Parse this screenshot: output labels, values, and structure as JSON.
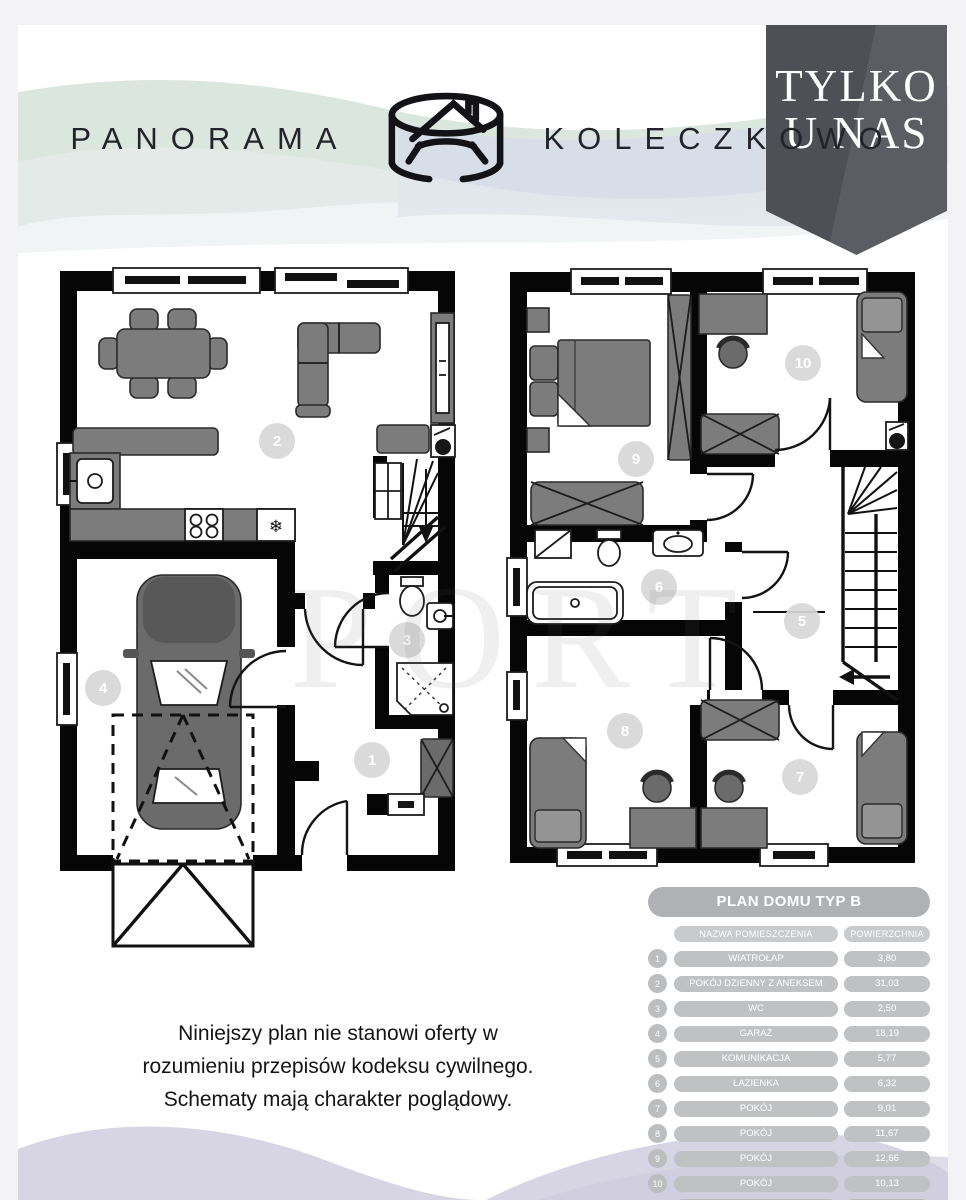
{
  "header": {
    "brand_left": "PANORAMA",
    "brand_right": "KOLECZKOWO"
  },
  "ribbon": {
    "line1": "TYLKO",
    "line2": "U NAS"
  },
  "watermark": {
    "text": "PORT"
  },
  "plan_labels": {
    "n1": "1",
    "n2": "2",
    "n3": "3",
    "n4": "4",
    "n5": "5",
    "n6": "6",
    "n7": "7",
    "n8": "8",
    "n9": "9",
    "n10": "10"
  },
  "icons": {
    "fridge": "❄",
    "house_logo": "circular-house-logo"
  },
  "disclaimer": {
    "line1": "Niniejszy plan nie stanowi oferty w",
    "line2": "rozumieniu przepisów kodeksu cywilnego.",
    "line3": "Schematy mają charakter poglądowy."
  },
  "table": {
    "title": "PLAN DOMU TYP B",
    "col_name": "NAZWA POMIESZCZENIA",
    "col_area": "POWIERZCHNIA",
    "rows": [
      {
        "no": "1",
        "name": "WIATROŁAP",
        "area": "3,80"
      },
      {
        "no": "2",
        "name": "POKÓJ DZIENNY Z ANEKSEM",
        "area": "31,03"
      },
      {
        "no": "3",
        "name": "WC",
        "area": "2,50"
      },
      {
        "no": "4",
        "name": "GARAŻ",
        "area": "18,19"
      },
      {
        "no": "5",
        "name": "KOMUNIKACJA",
        "area": "5,77"
      },
      {
        "no": "6",
        "name": "ŁAZIENKA",
        "area": "6,32"
      },
      {
        "no": "7",
        "name": "POKÓJ",
        "area": "9,01"
      },
      {
        "no": "8",
        "name": "POKÓJ",
        "area": "11,67"
      },
      {
        "no": "9",
        "name": "POKÓJ",
        "area": "12,66"
      },
      {
        "no": "10",
        "name": "POKÓJ",
        "area": "10,13"
      }
    ],
    "sum_label": "SUMA POWIERZCHNI",
    "sum_value": "111,08"
  },
  "colors": {
    "page_bg": "#f3f3f5",
    "card_bg": "#ffffff",
    "ribbon_bg": "#53555a",
    "ribbon_text": "#ffffff",
    "wave_green": "#dbe6df",
    "wave_blue": "#d6dde8",
    "wave_lavender": "#d7d4e4",
    "wave_teal": "#e0e9e5",
    "wall": "#060606",
    "furniture": "#7c7c7c",
    "table_title_bg": "#b0b1b4",
    "table_pill_bg": "#c0c1c3",
    "table_text": "#ffffff"
  }
}
